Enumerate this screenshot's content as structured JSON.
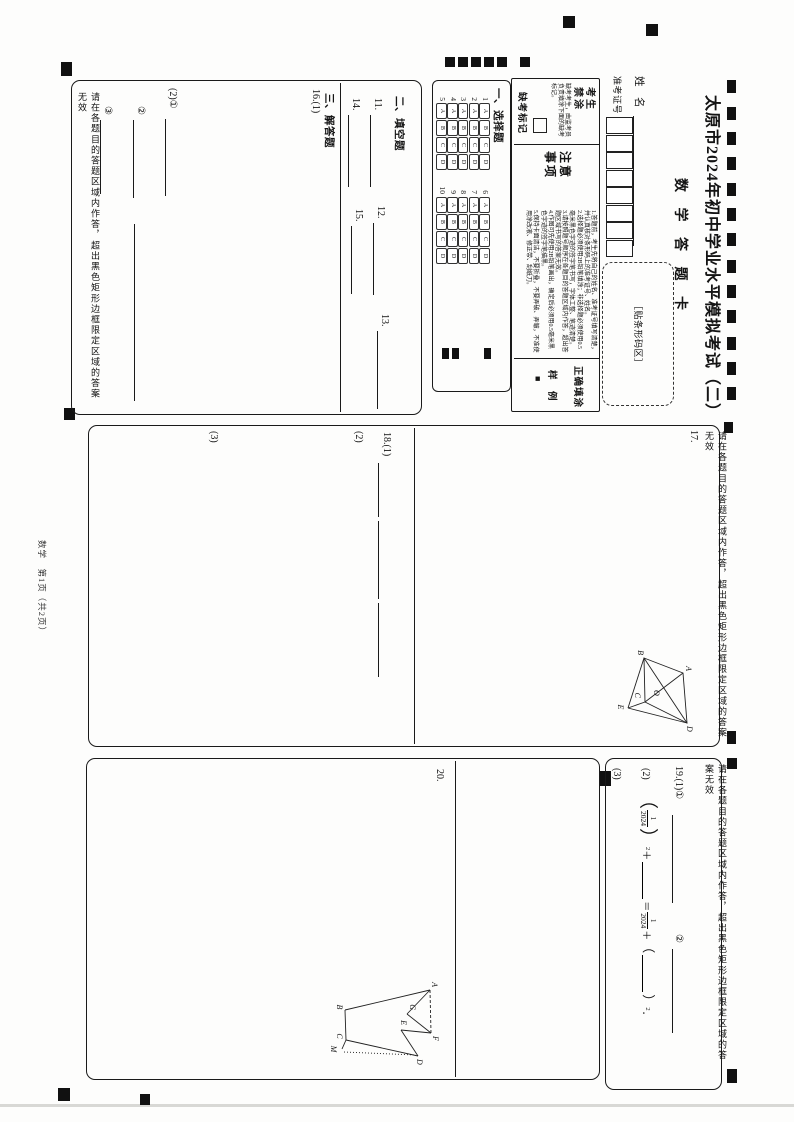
{
  "page": {
    "title": "太原市2024年初中学业水平模拟考试（二）",
    "subtitle": "数 学 答 题 卡",
    "footer": "数学　第1页（共2页）",
    "region_warning": "请在各题目的答题区域内作答，超出黑色矩形边框限定区域的答案无效"
  },
  "header": {
    "name_label": "姓　名",
    "id_label": "准考证号",
    "barcode_label": "［贴条形码区］",
    "notice": {
      "no_fill_title": "考生禁涂",
      "no_fill_text": "缺考考生，由监考员负责填涂下面的缺考标记。",
      "absent_label": "缺考标记",
      "notes_title": "注意事项",
      "notes": [
        "1.答题前，考生先将自己的姓名、准考证号填写清楚，并认真核对条形码上的准考证号、姓名。",
        "2.选择题必须使用2B铅笔填涂；非选择题必须使用0.5毫米黑色字迹的签字笔书写，字体工整、笔迹清楚。",
        "3.请按照题号顺序在各题目的答题区域内作答，超出答题区域书写的答案无效。",
        "4.作图可先使用2B铅笔画出，确定后必须用0.5毫米黑色字迹的签字笔描黑。",
        "5.保持卡面清洁，不要折叠，不要弄破、弄皱，不准使用涂改液、修正带、刮纸刀。"
      ],
      "sample_title": "正确填涂",
      "sample_label": "样　例",
      "sample_mark": "■"
    }
  },
  "mcq": {
    "section_title": "一、选择题",
    "options": [
      "A",
      "B",
      "C",
      "D"
    ],
    "col1": [
      "1",
      "2",
      "3",
      "4",
      "5"
    ],
    "col2": [
      "6",
      "7",
      "8",
      "9",
      "10"
    ]
  },
  "fill": {
    "section_title": "二、填空题",
    "q11": "11.",
    "q12": "12.",
    "q13": "13.",
    "q14": "14.",
    "q15": "15."
  },
  "solve": {
    "section_title": "三、解答题",
    "q16": "16.(1)",
    "q16_sub2": "(2)①",
    "q16_sub2b": "②",
    "q16_sub2c": "③"
  },
  "q17": {
    "label": "17.",
    "points": [
      "A",
      "B",
      "C",
      "D",
      "E",
      "O"
    ]
  },
  "q18": {
    "label": "18.(1)",
    "sub2": "(2)",
    "sub3": "(3)"
  },
  "q19": {
    "label": "19.(1)①",
    "circle2": "②",
    "sub2": "(2)",
    "sub3": "(3)",
    "expr": {
      "open": "（",
      "num1": "1",
      "den1": "2024",
      "close": "）",
      "sq": "2",
      "plus": "＋",
      "eq": "＝",
      "num2": "1",
      "den2": "2024",
      "open2": "（",
      "close2": "）",
      "end": "．"
    }
  },
  "q20": {
    "label": "20.",
    "points": [
      "A",
      "B",
      "C",
      "D",
      "E",
      "F",
      "G",
      "M"
    ]
  }
}
